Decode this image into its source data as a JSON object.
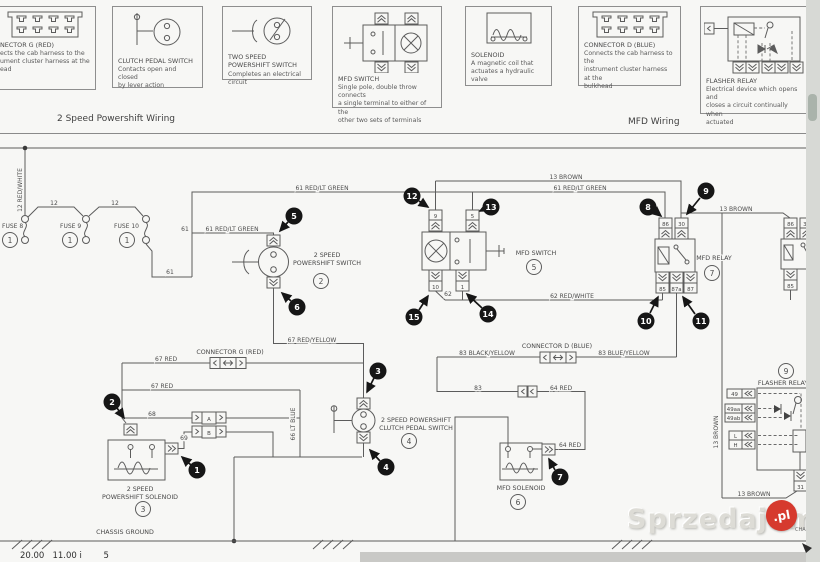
{
  "window": {
    "left_section": "2 Speed Powershift Wiring",
    "right_section": "MFD Wiring"
  },
  "legend": [
    {
      "title": "NECTOR G (RED)",
      "desc": [
        "ects the cab harness to the",
        "ument cluster harness at the",
        "ead"
      ]
    },
    {
      "title": "CLUTCH PEDAL SWITCH",
      "desc": [
        "Contacts open and closed",
        "by lever action"
      ]
    },
    {
      "title": "TWO SPEED",
      "title2": "POWERSHIFT SWITCH",
      "desc": [
        "Completes an electrical circuit"
      ]
    },
    {
      "title": "MFD SWITCH",
      "desc": [
        "Single pole, double throw connects",
        "a single terminal to either of the",
        "other two sets of terminals"
      ]
    },
    {
      "title": "SOLENOID",
      "desc": [
        "A magnetic coil that",
        "actuates a hydraulic valve"
      ]
    },
    {
      "title": "CONNECTOR D (BLUE)",
      "desc": [
        "Connects the cab harness to the",
        "instrument cluster harness at the",
        "bulkhead"
      ]
    },
    {
      "title": "FLASHER RELAY",
      "desc": [
        "Electrical device which opens and",
        "closes a circuit continually when",
        "actuated"
      ]
    }
  ],
  "wires": [
    "12 RED/WHITE",
    "12",
    "12",
    "61",
    "61",
    "61 RED/LT GREEN",
    "61 RED/LT GREEN",
    "61 RED/LT GREEN",
    "13 BROWN",
    "13 BROWN",
    "13 BROWN",
    "13 BROWN",
    "62",
    "62 RED/WHITE",
    "67 RED/YELLOW",
    "67 RED",
    "67 RED",
    "66 LT BLUE",
    "68",
    "69",
    "83 BLACK/YELLOW",
    "83 BLUE/YELLOW",
    "83",
    "64 RED",
    "64 RED"
  ],
  "terminals": [
    "9",
    "5",
    "10",
    "1",
    "86",
    "30",
    "85",
    "87a",
    "87",
    "86",
    "31",
    "85",
    "A",
    "B",
    "49",
    "49aa",
    "49ab",
    "L",
    "H",
    "31"
  ],
  "components": {
    "fuse8": "FUSE 8",
    "fuse9": "FUSE 9",
    "fuse10": "FUSE 10",
    "ps_switch1": "2 SPEED",
    "ps_switch2": "POWERSHIFT SWITCH",
    "mfd_switch": "MFD SWITCH",
    "mfd_relay": "MFD RELAY",
    "clutch1": "2 SPEED POWERSHIFT",
    "clutch2": "CLUTCH PEDAL SWITCH",
    "ps_sol1": "2 SPEED",
    "ps_sol2": "POWERSHIFT SOLENOID",
    "mfd_sol": "MFD SOLENOID",
    "flasher": "FLASHER RELAY",
    "conn_g": "CONNECTOR G (RED)",
    "conn_d": "CONNECTOR D (BLUE)",
    "ground": "CHASSIS GROUND"
  },
  "callouts": [
    "1",
    "2",
    "3",
    "4",
    "5",
    "6",
    "7",
    "8",
    "9",
    "10",
    "11",
    "12",
    "13",
    "14",
    "15"
  ],
  "refs": [
    "1",
    "1",
    "1",
    "2",
    "3",
    "4",
    "5",
    "6",
    "7",
    "9"
  ],
  "watermark": {
    "name": "Sprzedajemy",
    "tld": ".pl"
  },
  "bottom": {
    "clock": "20.00   11.00 i        5",
    "edge": "CHA"
  }
}
